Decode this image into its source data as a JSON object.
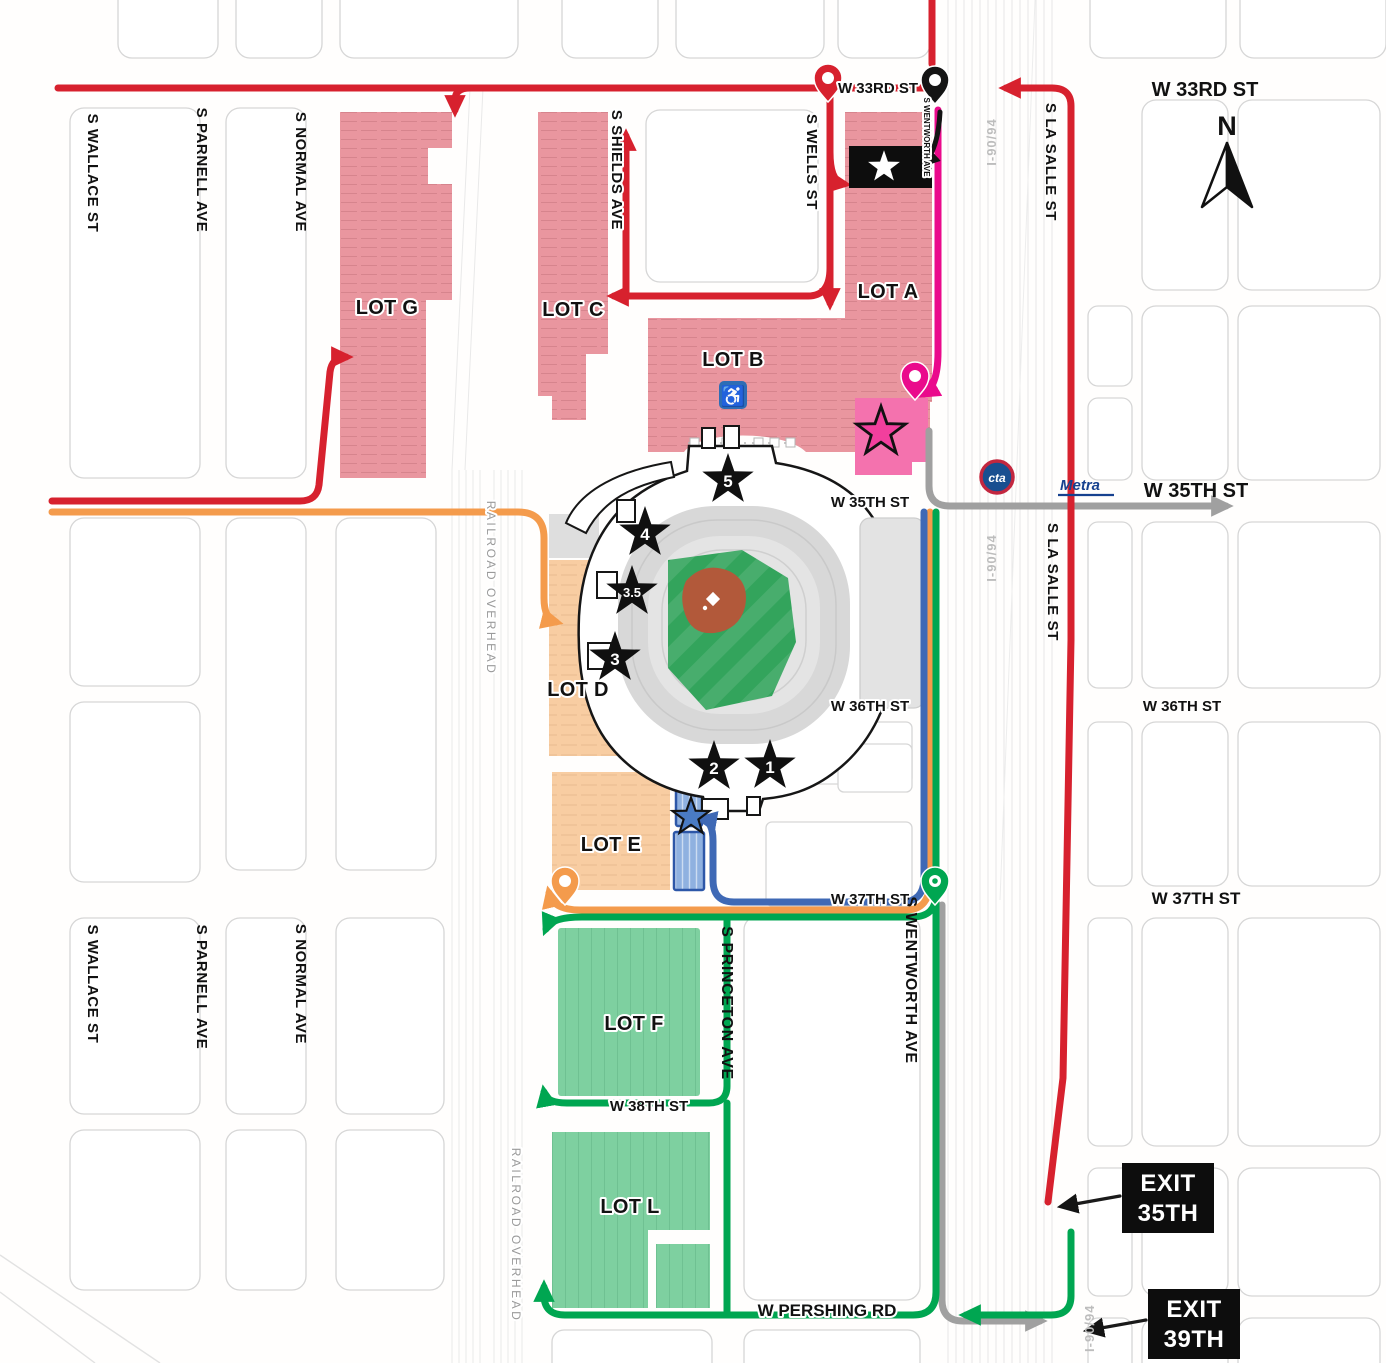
{
  "streets": {
    "w33rd": "W 33RD ST",
    "w35th": "W 35TH ST",
    "w36th": "W 36TH ST",
    "w37th": "W 37TH ST",
    "w38th": "W 38TH ST",
    "pershing": "W PERSHING RD",
    "wallace": "S WALLACE ST",
    "parnell": "S PARNELL AVE",
    "normal": "S NORMAL AVE",
    "shields": "S SHIELDS AVE",
    "wells": "S WELLS ST",
    "wentworth": "S WENTWORTH AVE",
    "princeton": "S PRINCETON AVE",
    "lasalle": "S LA SALLE ST",
    "expressway": "I-90/94",
    "railroad_overhead": "RAILROAD  OVERHEAD"
  },
  "lots": {
    "a": "LOT A",
    "b": "LOT B",
    "c": "LOT C",
    "d": "LOT D",
    "e": "LOT E",
    "f": "LOT F",
    "g": "LOT G",
    "l": "LOT L"
  },
  "gates": {
    "gate1": "1",
    "gate2": "2",
    "gate3": "3",
    "gate3_5": "3.5",
    "gate4": "4",
    "gate5": "5"
  },
  "exits": {
    "exit35": {
      "line1": "EXIT",
      "line2": "35TH"
    },
    "exit39": {
      "line1": "EXIT",
      "line2": "39TH"
    }
  },
  "compass": {
    "north": "N"
  },
  "transit": {
    "cta": "cta",
    "metra": "Metra"
  },
  "accessible_icon": "♿",
  "colors": {
    "lot_pink": "#e9969f",
    "lot_peach": "#f8cda2",
    "lot_green": "#7ed0a0",
    "lot_premium_pink": "#f472ae",
    "route_red": "#d7212e",
    "route_magenta": "#ea0a8c",
    "route_orange": "#f49b4c",
    "route_blue": "#3f69b5",
    "route_green": "#00a651",
    "route_gray": "#a0a0a0",
    "field_green": "#33a45c",
    "infield_brown": "#b2593a"
  }
}
